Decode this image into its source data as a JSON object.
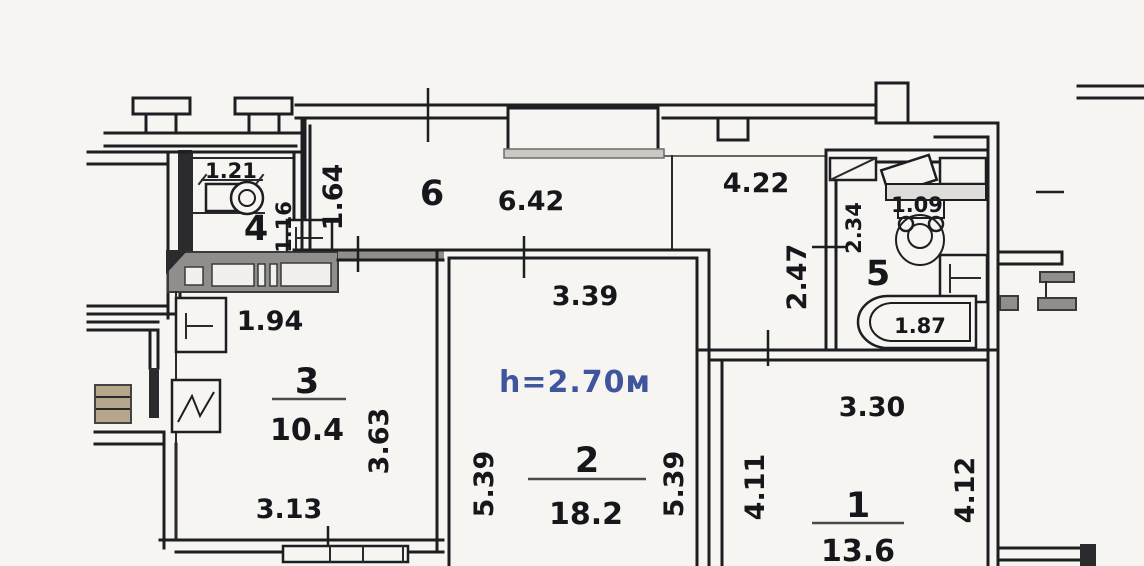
{
  "plan": {
    "ceiling": "h=2.70м",
    "rooms": {
      "r1": {
        "number": "1",
        "area": "13.6",
        "width_top": "3.30",
        "height_left": "4.11",
        "height_right": "4.12"
      },
      "r2": {
        "number": "2",
        "area": "18.2",
        "width_top": "3.39",
        "height_left": "5.39",
        "height_right": "5.39"
      },
      "r3": {
        "number": "3",
        "area": "10.4",
        "width_top": "1.94",
        "width_bottom": "3.13",
        "height_right": "3.63"
      },
      "r4": {
        "number": "4",
        "width_top": "1.21",
        "height_right": "1.16"
      },
      "r5": {
        "number": "5",
        "height_left": "2.34",
        "toilet_dim": "1.09",
        "bath_length": "1.87"
      },
      "r6": {
        "number": "6",
        "length_top": "6.42",
        "width_left": "1.64"
      }
    },
    "hall": {
      "length_top": "4.22",
      "height_left": "2.47"
    },
    "colors": {
      "paper": "#f6f5f2",
      "wall": "#1e1e22",
      "shade": "#8f8e8a",
      "accent_blue": "#3f569f",
      "beige": "#b6a78c"
    }
  }
}
